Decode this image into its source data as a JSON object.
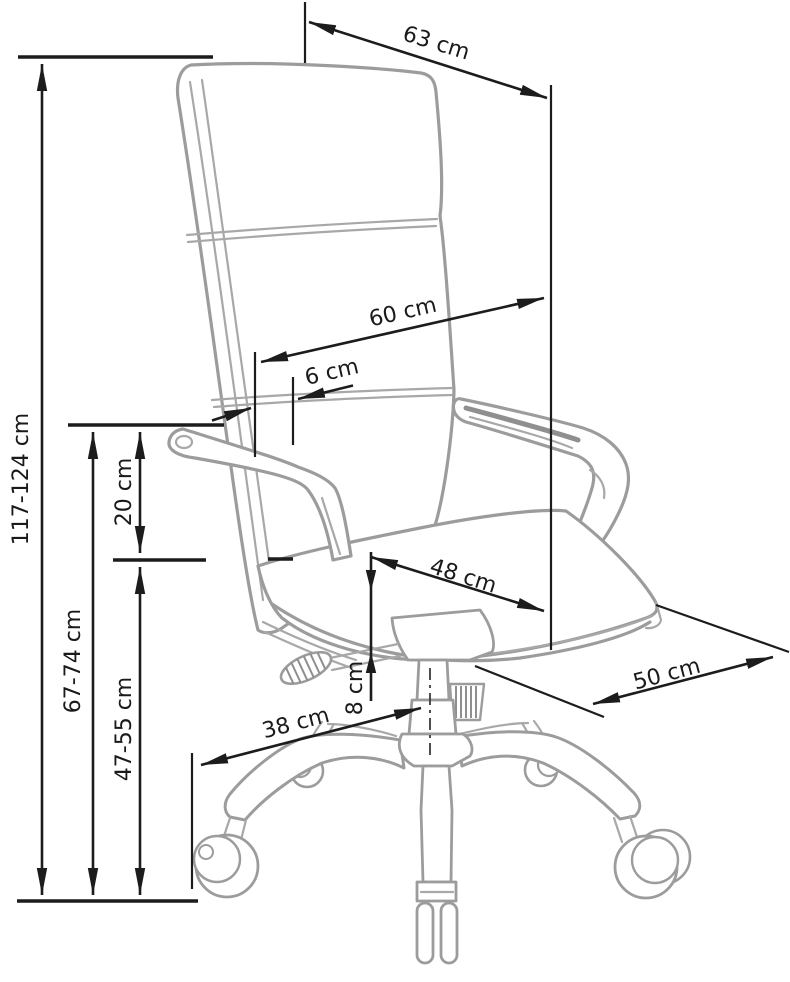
{
  "figure": {
    "description": "Office swivel chair technical dimension drawing",
    "unit": "cm",
    "labels": {
      "total_height": "117-124 cm",
      "armrest_floor_height": "67-74 cm",
      "armrest_seat_height": "20 cm",
      "seat_height": "47-55 cm",
      "top_width": "63 cm",
      "backrest_width": "60 cm",
      "backrest_armrest_gap": "6 cm",
      "seat_width": "48 cm",
      "seat_thickness": "8 cm",
      "base_leg_length": "38 cm",
      "seat_depth": "50 cm"
    }
  }
}
